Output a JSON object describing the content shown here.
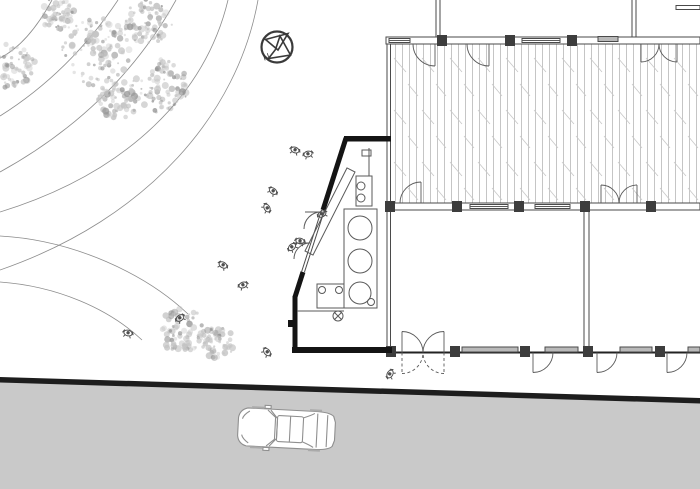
{
  "meta": {
    "type": "architectural-site-plan",
    "canvas_w": 700,
    "canvas_h": 489
  },
  "colors": {
    "line": "#4a4a4a",
    "wall_dark": "#141414",
    "detail": "#5a5a5a",
    "hatch": "#b7b7b7",
    "hatch_diag": "#c8c8c8",
    "road_fill": "#c9c9c9",
    "road_edge": "#1d1d1d",
    "window_fill": "#b9b9b9",
    "column_fill": "#3d3d3d",
    "tree": "#c3c3c3",
    "tree_dark": "#969696",
    "people": "#4f4f4f",
    "car_line": "#8f8f8f",
    "contour": "#8c8c8c"
  },
  "north_arrow": {
    "label": "N",
    "cx": 277,
    "cy": 47,
    "r": 15.5
  },
  "landscape": {
    "contours": [
      "M52,0 Q28,44 0,58",
      "M118,0 Q70,72 0,116",
      "M176,0 Q116,108 0,172",
      "M228,0 C206,92 130,172 0,212",
      "M258,0 C238,112 150,218 0,270",
      "M0,236 C74,240 146,274 188,314",
      "M0,282 C56,286 108,308 142,340"
    ],
    "trees": [
      [
        12,
        66,
        24
      ],
      [
        58,
        14,
        18
      ],
      [
        98,
        52,
        36
      ],
      [
        148,
        22,
        24
      ],
      [
        160,
        86,
        28
      ],
      [
        118,
        100,
        20
      ]
    ],
    "bushes": [
      [
        182,
        330,
        24
      ],
      [
        218,
        342,
        17
      ]
    ],
    "people": [
      [
        295,
        150,
        20
      ],
      [
        308,
        154,
        -15
      ],
      [
        273,
        191,
        40
      ],
      [
        322,
        214,
        -30
      ],
      [
        300,
        241,
        10
      ],
      [
        267,
        208,
        60
      ],
      [
        292,
        247,
        -45
      ],
      [
        223,
        265,
        30
      ],
      [
        243,
        285,
        -20
      ],
      [
        128,
        333,
        15
      ],
      [
        180,
        318,
        -35
      ],
      [
        267,
        352,
        50
      ],
      [
        390,
        374,
        -60
      ]
    ]
  },
  "road": {
    "edge_band": "0,377 700,398 700,403.5 0,382.5",
    "surface": "0,382 700,403 700,489 0,489"
  },
  "car": {
    "x": 237,
    "y": 408,
    "w": 100,
    "h": 42,
    "rot": 3
  },
  "deck": {
    "x": 391,
    "y": 44,
    "w": 309,
    "h": 159
  },
  "building": {
    "top_wall": [
      386,
      37,
      314,
      7
    ],
    "mid_wall": [
      386,
      203,
      314,
      7
    ],
    "bottom_wall_y": 352.5,
    "columns": [
      [
        437,
        35
      ],
      [
        505,
        35
      ],
      [
        567,
        35
      ],
      [
        385,
        201
      ],
      [
        452,
        201
      ],
      [
        514,
        201
      ],
      [
        580,
        201
      ],
      [
        646,
        201
      ],
      [
        386,
        346
      ],
      [
        450,
        346
      ],
      [
        520,
        346
      ],
      [
        583,
        346
      ],
      [
        655,
        346
      ]
    ],
    "col_w": 10,
    "col_h": 11,
    "line_windows": [
      [
        389,
        410,
        40.5
      ],
      [
        522,
        560,
        40.5
      ],
      [
        470,
        508,
        206.5
      ],
      [
        535,
        570,
        206.5
      ]
    ],
    "gray_windows": [
      [
        598,
        618,
        36.5
      ],
      [
        462,
        518,
        347
      ],
      [
        545,
        578,
        347
      ],
      [
        620,
        652,
        347
      ],
      [
        688,
        700,
        347
      ]
    ],
    "partitions_up_x": [
      438,
      634
    ],
    "top_stub": [
      676,
      5.5,
      24,
      4
    ],
    "mid_partition": [
      584,
      210,
      5,
      137
    ],
    "left_edge_x": [
      387,
      390.5
    ],
    "left_edge_y": [
      44,
      352
    ],
    "doors_top_down": [
      [
        435,
        22
      ],
      [
        489,
        22
      ]
    ],
    "double_door_top": {
      "hl": 641,
      "hr": 677,
      "r": 18
    },
    "door_mid_up": {
      "hinge": 421,
      "r": 21
    },
    "double_door_mid": {
      "hl": 601,
      "hr": 637,
      "r": 18
    },
    "butterfly": {
      "hl": 402,
      "hr": 444,
      "r": 21
    },
    "doors_bottom_down": [
      [
        533,
        20
      ],
      [
        597,
        20
      ],
      [
        667,
        20
      ]
    ]
  },
  "kiosk": {
    "top_wall": [
      344,
      136,
      47,
      5.5
    ],
    "angled_segments": [
      [
        346,
        138,
        323,
        210
      ],
      [
        303,
        272,
        295,
        297
      ]
    ],
    "angled_open": [
      323,
      210,
      303,
      272
    ],
    "left_wall": [
      292.5,
      296,
      5,
      56
    ],
    "bottom_wall": [
      292,
      347,
      100,
      6
    ],
    "notch": [
      288,
      320,
      7,
      7
    ],
    "counter": [
      344,
      209,
      33,
      99
    ],
    "counter_circles": [
      [
        360,
        228,
        12
      ],
      [
        360,
        261,
        12
      ],
      [
        360,
        293,
        11
      ]
    ],
    "small_circle": [
      371,
      302,
      3.5
    ],
    "fixture_top": {
      "rect": [
        356,
        176,
        16,
        30
      ],
      "circles": [
        [
          361,
          186,
          4
        ],
        [
          361,
          198,
          4
        ]
      ],
      "stem": [
        369,
        148,
        369,
        176
      ],
      "cap": [
        362,
        150,
        9,
        6
      ]
    },
    "ramp": {
      "x1": 309,
      "y1": 253,
      "x2": 351,
      "y2": 170,
      "w": 9
    },
    "fixture_bottom": {
      "rect": [
        317,
        284,
        27,
        24
      ],
      "circles": [
        [
          322,
          290,
          3.5
        ],
        [
          339,
          290,
          3.5
        ]
      ]
    },
    "drain": [
      338,
      316,
      5
    ],
    "floor_line": [
      297,
      311,
      344,
      311
    ],
    "door_arcs": [
      "M321,212 A17,17 0 0 0 304,229",
      "M310,243 A16,16 0 0 0 294,259"
    ],
    "door_leaves": [
      "M321,212 L305,212",
      "M310,243 L295,243"
    ]
  }
}
